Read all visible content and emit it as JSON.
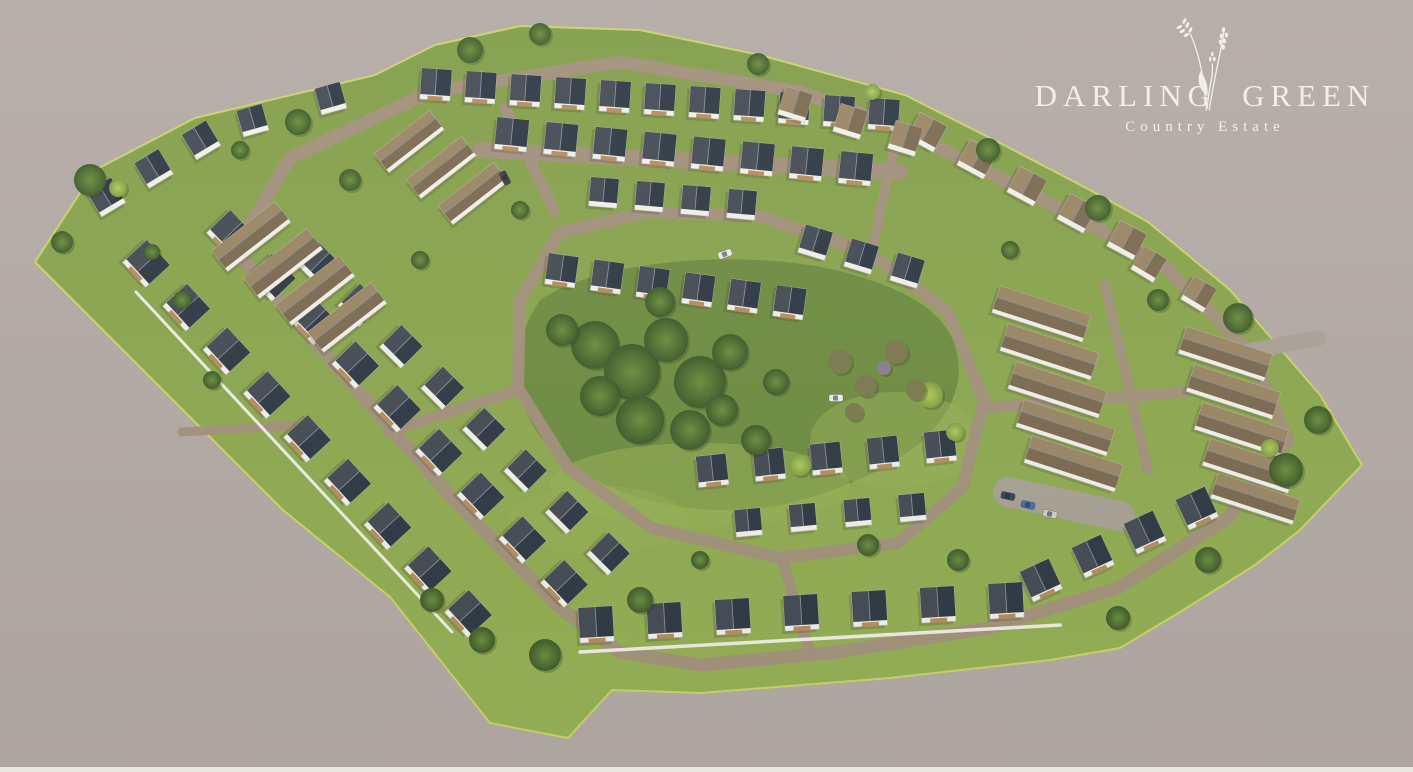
{
  "logo": {
    "title_left": "DARLING",
    "title_right": "GREEN",
    "subtitle": "Country Estate",
    "icon": "wheat-sprig-icon",
    "text_color": "#f2efe9"
  },
  "scene": {
    "description": "Aerial 3D render of the Darling Green country estate: white gabled houses with dark and thatch-brown roofs along looped brick roads around a central tree-filled green park",
    "palette": {
      "background": "#b3aaa5",
      "bottom_strip": "#e9e7e1",
      "grass_top": "#819d49",
      "grass_bottom": "#97b257",
      "grass_edge": "#c8d468",
      "park_green": "#6e8b41",
      "road_brick": "#a3907d",
      "road_gray": "#a9a198",
      "house_wall": "#f2f0ea",
      "wall_shade": "#c9c5bb",
      "roof_dark_1": "#454c55",
      "roof_dark_2": "#2f3a46",
      "roof_brown_1": "#9a8766",
      "roof_brown_2": "#7c6b51",
      "ridge": "#8a8f96",
      "deck_wood": "#b68d5f",
      "tree_dark_1": "#6d8f3f",
      "tree_dark_2": "#3f5c2a",
      "tree_light_1": "#b3c95e",
      "tree_light_2": "#7fa042",
      "bush_olive": "#7b7a4f",
      "bush_purple": "#8a7f91"
    }
  }
}
